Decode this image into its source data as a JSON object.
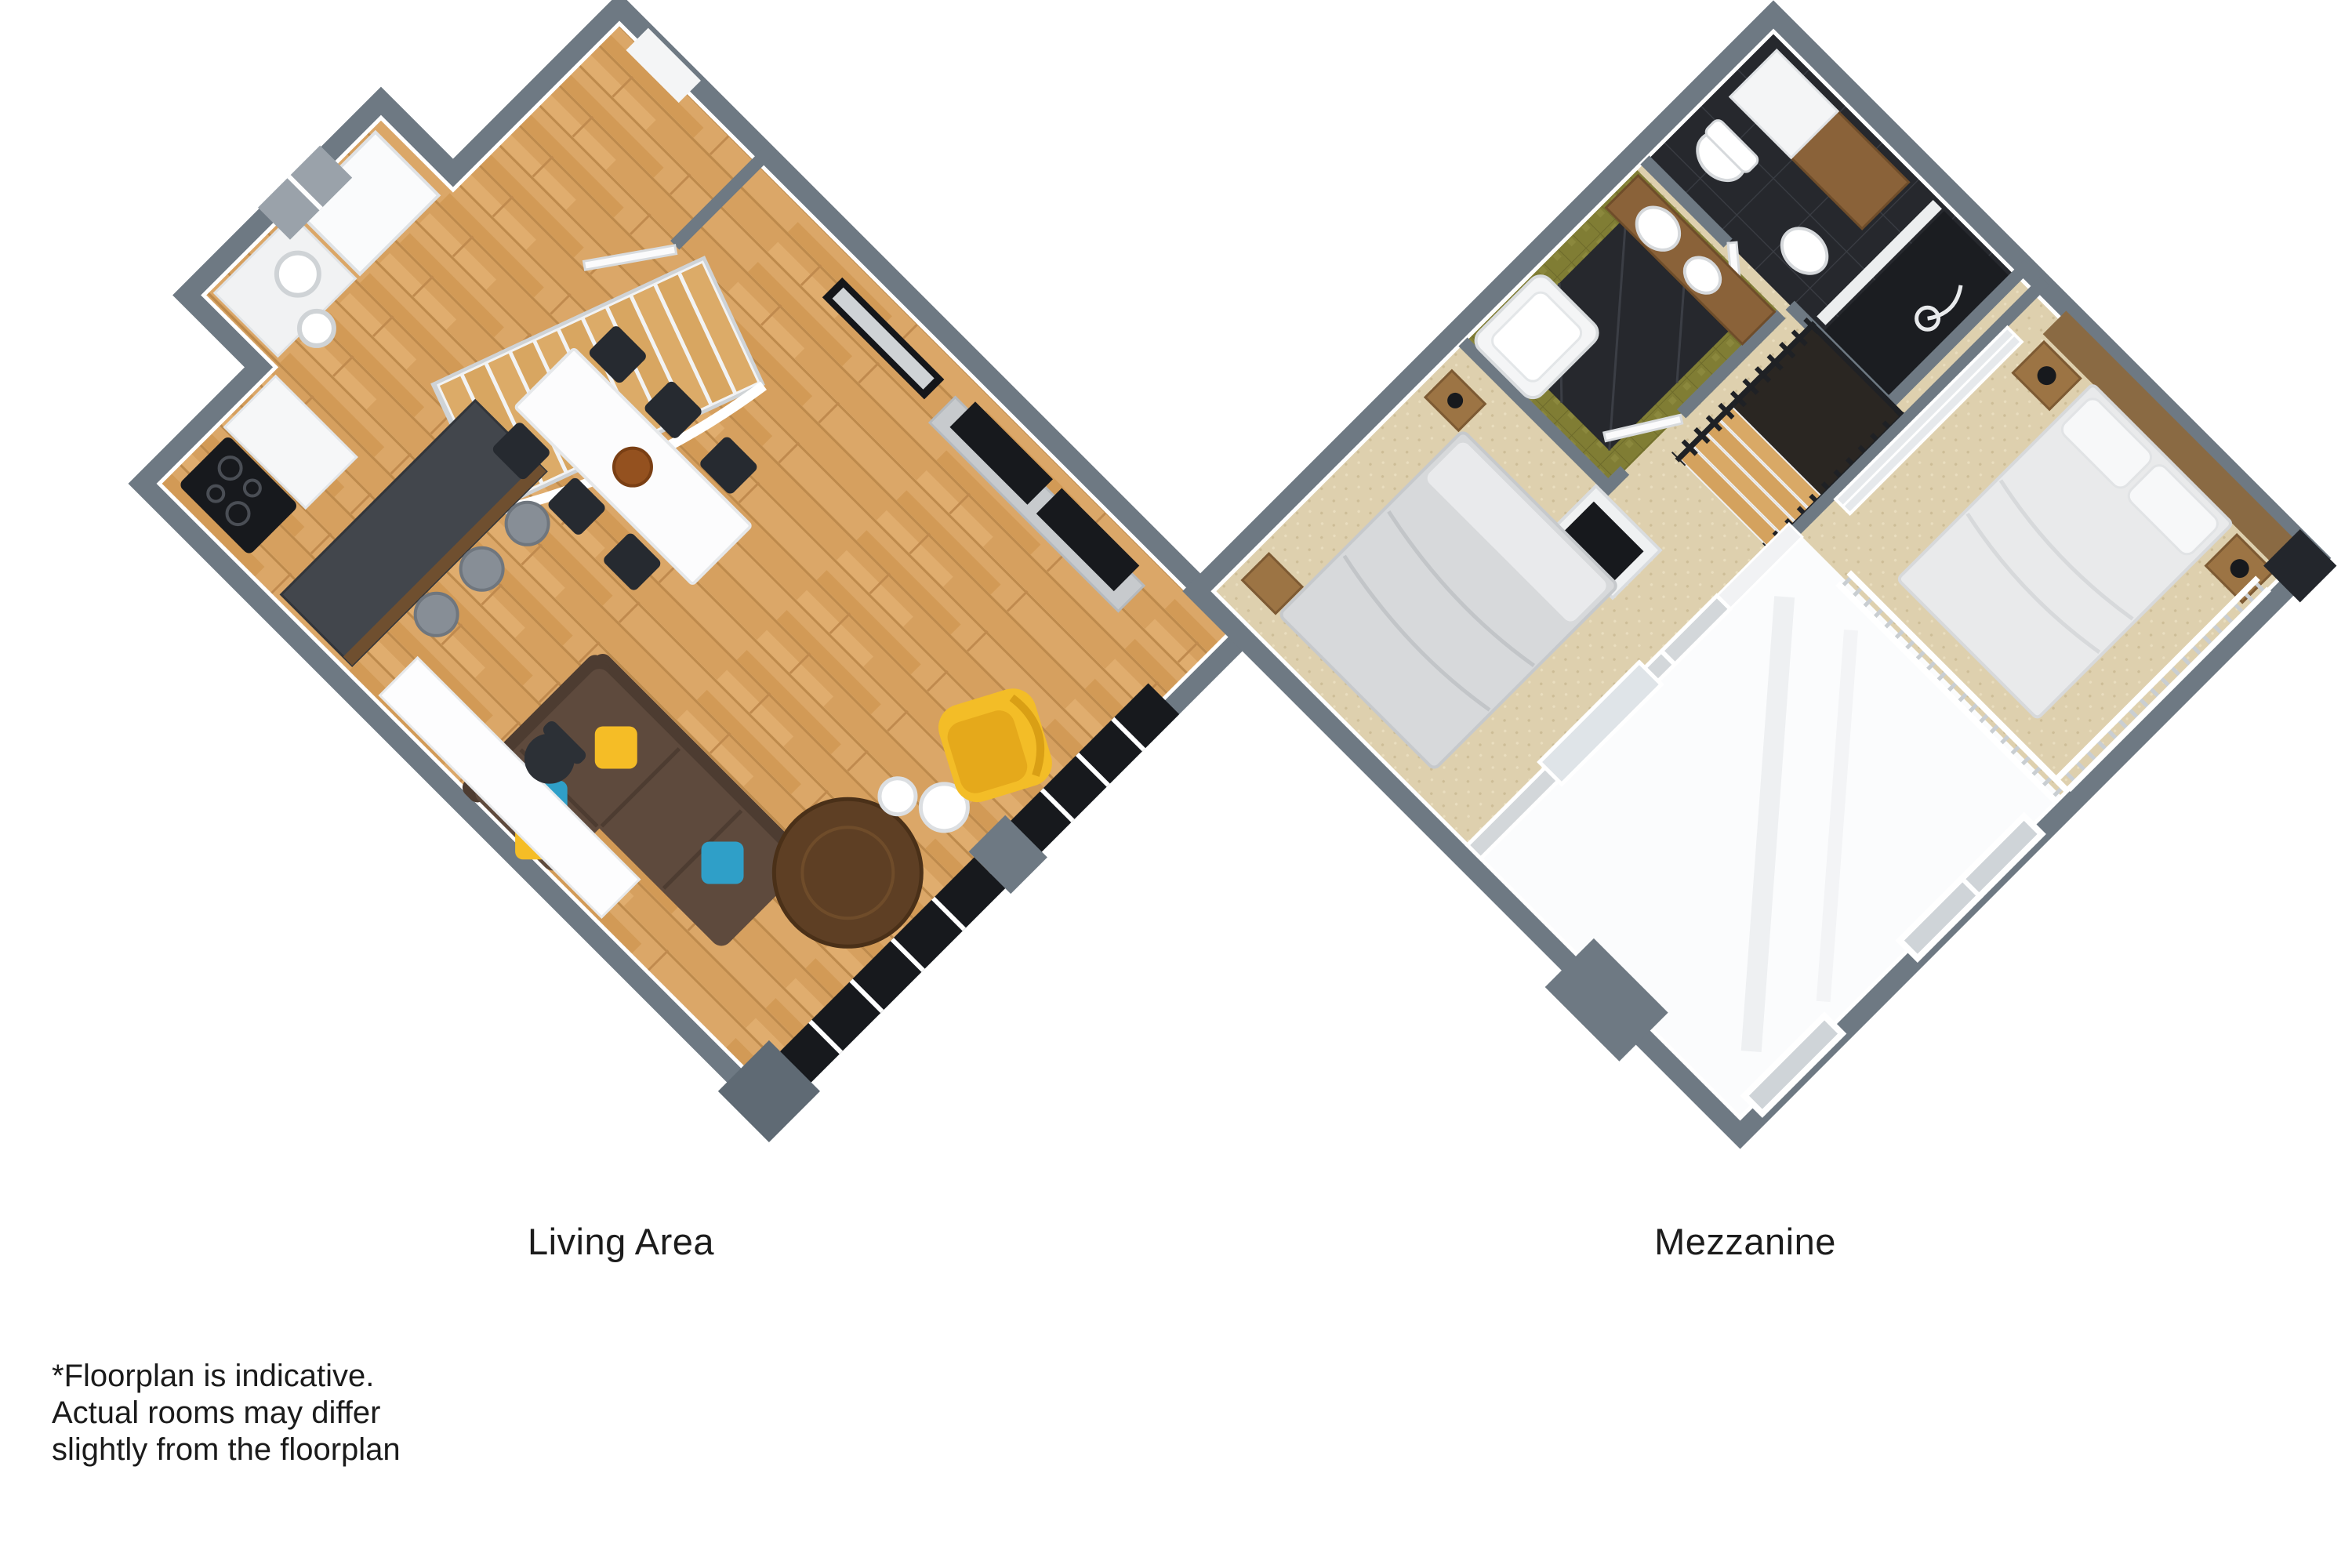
{
  "captions": {
    "left": "Living Area",
    "right": "Mezzanine"
  },
  "disclaimer": {
    "line1": "*Floorplan is indicative.",
    "line2": "Actual rooms may differ",
    "line3": "slightly from the floorplan"
  },
  "floorplans": [
    {
      "id": "living-area",
      "label": "Living Area",
      "style": "3d-isometric",
      "features": [
        "entry-door",
        "staircase",
        "kitchen-island",
        "bar-stools",
        "fridge",
        "cooktop",
        "dining-table",
        "dining-chairs",
        "wall-picture",
        "tv-console",
        "tv-screens",
        "l-shaped-sofa",
        "throw-cushions",
        "round-coffee-table",
        "side-tables",
        "yellow-armchair",
        "desk",
        "office-chair",
        "floor-to-ceiling-windows"
      ]
    },
    {
      "id": "mezzanine",
      "label": "Mezzanine",
      "style": "3d-isometric",
      "features": [
        "dark-tiled-bathroom",
        "toilet",
        "vanity",
        "shower-room",
        "olive-tiled-bathroom",
        "bathtub",
        "twin-sinks",
        "staircase-railing",
        "hallway",
        "wardrobe",
        "double-bed-1",
        "nightstands",
        "lamps",
        "tv-stub-wall",
        "double-bed-2",
        "glass-partition",
        "void-room",
        "windows"
      ]
    }
  ],
  "colors": {
    "background": "#ffffff",
    "wall_top": "#6e7983",
    "wall_dark": "#5f6a74",
    "wood_floor": "#d6a05f",
    "carpet": "#ded0ae",
    "dark_tile": "#26282d",
    "olive_tile": "#807d34",
    "island": "#42464c",
    "sofa": "#5e4a3d",
    "cushion_blue": "#2f9fc8",
    "cushion_yellow": "#f5bd26",
    "armchair_yellow": "#f3bd27",
    "coffee_table": "#5e3f24",
    "tv_black": "#17191d",
    "bed_linen": "#e9eaeb",
    "headboard_wood": "#8a6a43",
    "text": "#1c1c1c"
  }
}
